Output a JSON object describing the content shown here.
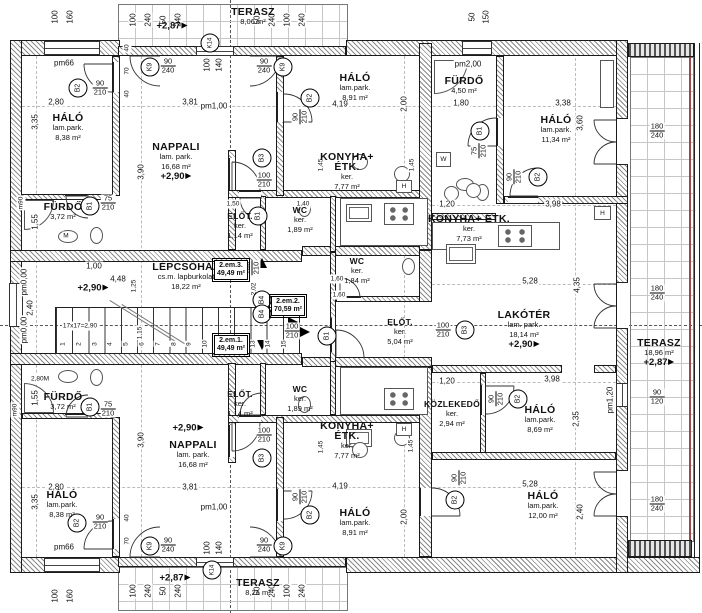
{
  "rooms": {
    "terasz_t": {
      "name": "TERASZ",
      "area": "8,06 m²",
      "level": "+2,87"
    },
    "halo_tl": {
      "name": "HÁLÓ",
      "finish": "lam.park.",
      "area": "8,38 m²"
    },
    "nappali_t": {
      "name": "NAPPALI",
      "finish": "lam. park.",
      "area": "16,68 m²",
      "level": "+2,90"
    },
    "furdo_tl": {
      "name": "FÜRDŐ",
      "area": "3,72 m²"
    },
    "elot_t": {
      "name": "ELŐT.",
      "finish": "ker.",
      "area": "1,14 m²"
    },
    "wc_t": {
      "name": "WC",
      "finish": "ker.",
      "area": "1,89 m²"
    },
    "konyha_t": {
      "name": "KONYHA+",
      "name2": "ÉTK.",
      "finish": "ker.",
      "area": "7,77 m²"
    },
    "halo_t2": {
      "name": "HÁLÓ",
      "finish": "lam.park.",
      "area": "8,91 m²"
    },
    "furdo_r": {
      "name": "FÜRDŐ",
      "area": "4,50 m²"
    },
    "halo_r1": {
      "name": "HÁLÓ",
      "finish": "lam.park.",
      "area": "11,34 m²"
    },
    "konyha_r": {
      "name": "KONYHA+ ÉTK.",
      "finish": "ker.",
      "area": "7,73 m²"
    },
    "lakoter": {
      "name": "LAKÓTÉR",
      "finish": "lam. park.",
      "area": "18,14 m²",
      "level": "+2,90"
    },
    "wc_c": {
      "name": "WC",
      "finish": "ker.",
      "area": "1,84 m²"
    },
    "elot_r": {
      "name": "ELŐT.",
      "finish": "ker.",
      "area": "5,04 m²"
    },
    "kozlekedo": {
      "name": "KÖZLEKEDŐ",
      "finish": "ker.",
      "area": "2,94 m²"
    },
    "halo_r2": {
      "name": "HÁLÓ",
      "finish": "lam.park.",
      "area": "8,69 m²"
    },
    "halo_r3": {
      "name": "HÁLÓ",
      "finish": "lam.park.",
      "area": "12,00 m²"
    },
    "terasz_r": {
      "name": "TERASZ",
      "area": "18,96 m²",
      "level": "+2,87"
    },
    "lepcsohaz": {
      "name": "LÉPCSŐHÁZ",
      "finish": "cs.m. lapburkolat",
      "area": "18,22 m²",
      "level": "+2,90"
    },
    "elot_b": {
      "name": "ELŐT.",
      "finish": "ker.",
      "area": "1,14 m²"
    },
    "wc_b": {
      "name": "WC",
      "finish": "ker.",
      "area": "1,89 m²"
    },
    "konyha_b": {
      "name": "KONYHA+",
      "name2": "ÉTK.",
      "finish": "ker.",
      "area": "7,77 m²"
    },
    "halo_b2": {
      "name": "HÁLÓ",
      "finish": "lam.park.",
      "area": "8,91 m²"
    },
    "nappali_b": {
      "name": "NAPPALI",
      "finish": "lam. park.",
      "area": "16,68 m²",
      "level": "+2,90"
    },
    "furdo_bl": {
      "name": "FÜRDŐ",
      "area": "3,72 m²"
    },
    "halo_bl": {
      "name": "HÁLÓ",
      "finish": "lam.park.",
      "area": "8,38 m²"
    },
    "terasz_b": {
      "name": "TERASZ",
      "area": "8,21 m²",
      "level": "+2,87"
    }
  },
  "units": {
    "u1": {
      "label": "2.em.1.",
      "area": "49,49 m²"
    },
    "u2": {
      "label": "2.em.2.",
      "area": "70,59 m²"
    },
    "u3": {
      "label": "2.em.3.",
      "area": "49,49 m²"
    }
  },
  "tags": {
    "B1": "B1",
    "B2": "B2",
    "B3": "B3",
    "B4": "B4",
    "K9": "K9",
    "K14": "K14"
  },
  "door_sizes": {
    "d75": "75",
    "d90": "90",
    "d100": "100",
    "d120": "120",
    "d180": "180",
    "d210": "210",
    "d240": "240"
  },
  "pm": {
    "pm66": "pm66",
    "pm100": "pm1,00",
    "pm200": "pm2,00",
    "pm000": "pm0,00",
    "pm120": "pm1,20",
    "m90": "m90"
  },
  "stair": {
    "note": "17x17=2,90",
    "steps": [
      "1",
      "2",
      "3",
      "4",
      "5",
      "6",
      "7",
      "8",
      "9",
      "10",
      "11",
      "12",
      "13",
      "14",
      "15"
    ]
  },
  "fixtures": {
    "h": "H",
    "m": "M",
    "w": "W"
  },
  "dims": {
    "v100": "100",
    "v160": "160",
    "v50": "50",
    "v240": "240",
    "v150": "150",
    "win100": "100",
    "win140": "140",
    "v40": "40",
    "v70": "70",
    "v280": "2,80",
    "v280M": "2,80M",
    "v335": "3,35",
    "v390": "3,90",
    "v381": "3,81",
    "v419": "4,19",
    "v200": "2,00",
    "v338": "3,38",
    "v360": "3,60",
    "v180": "1,80",
    "v528": "5,28",
    "v435": "4,35",
    "v120": "1,20",
    "v398": "3,98",
    "v235": "2,35",
    "v240m": "2,40",
    "v100m": "1,00",
    "v448": "4,48",
    "v125": "1,25",
    "v115": "1,15",
    "v202": "2,02",
    "v155": "1,55",
    "v145": "1,45",
    "v140m": "1,40",
    "v150m": "1,50",
    "v160m": "1,60"
  }
}
